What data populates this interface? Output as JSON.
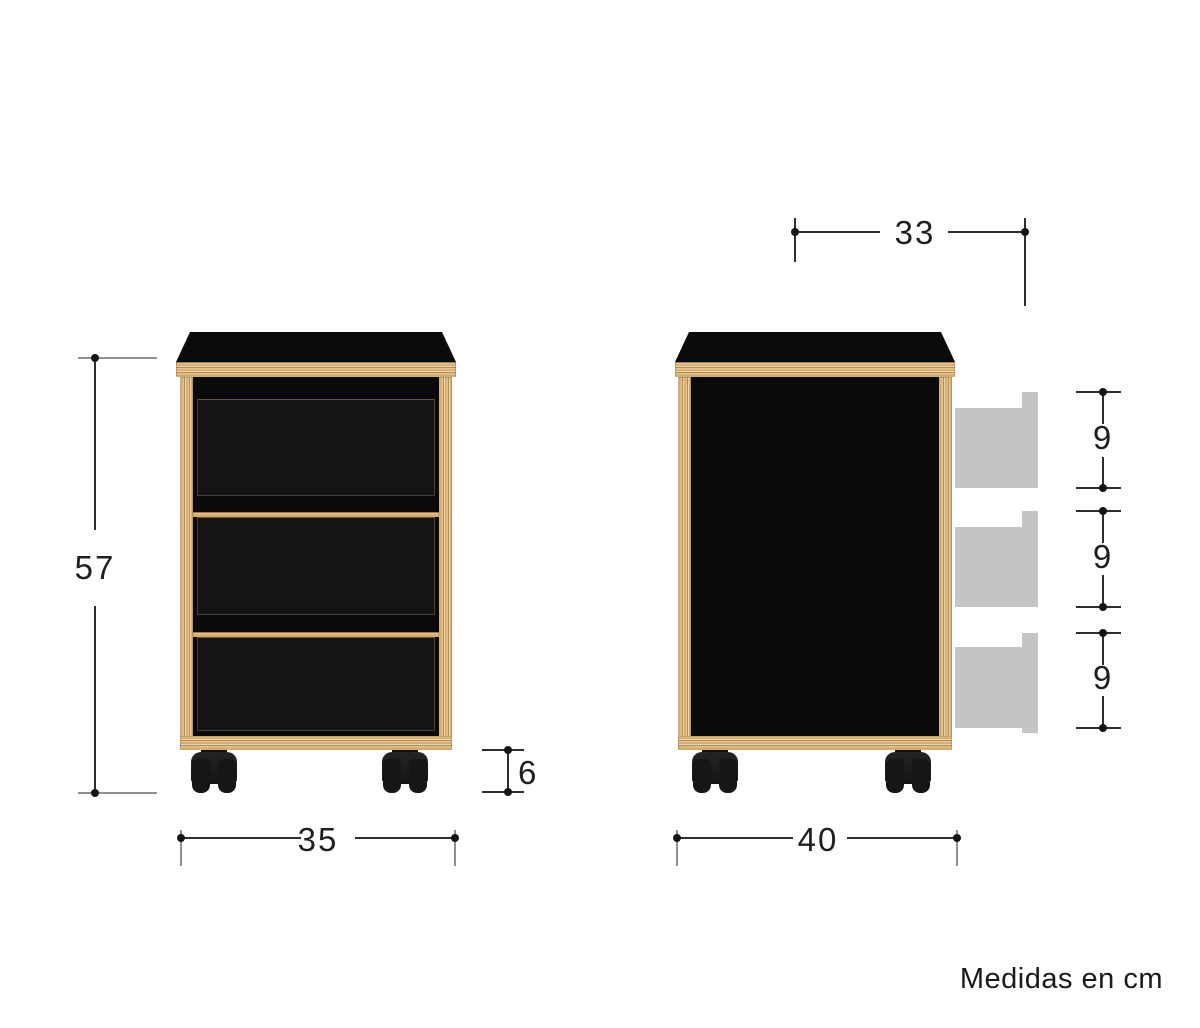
{
  "page": {
    "background": "#ffffff",
    "caption": "Medidas en cm"
  },
  "colors": {
    "wood_light": "#ecd6a8",
    "wood_mid": "#dcba85",
    "wood_dark": "#b98a52",
    "panel_black": "#0d0d0d",
    "drawer_gray": "#c5c5c5",
    "dim_line": "#2e2e2e",
    "dim_tick_gray": "#8f8f8f",
    "text": "#1f1f1f"
  },
  "views": {
    "front": {
      "label": "front-view",
      "drawer_count": 3,
      "dimensions": {
        "height": "57",
        "width": "35",
        "caster_height": "6"
      }
    },
    "side": {
      "label": "side-view",
      "dimensions": {
        "top_depth": "33",
        "depth": "40",
        "drawer_heights": [
          "9",
          "9",
          "9"
        ]
      }
    }
  }
}
